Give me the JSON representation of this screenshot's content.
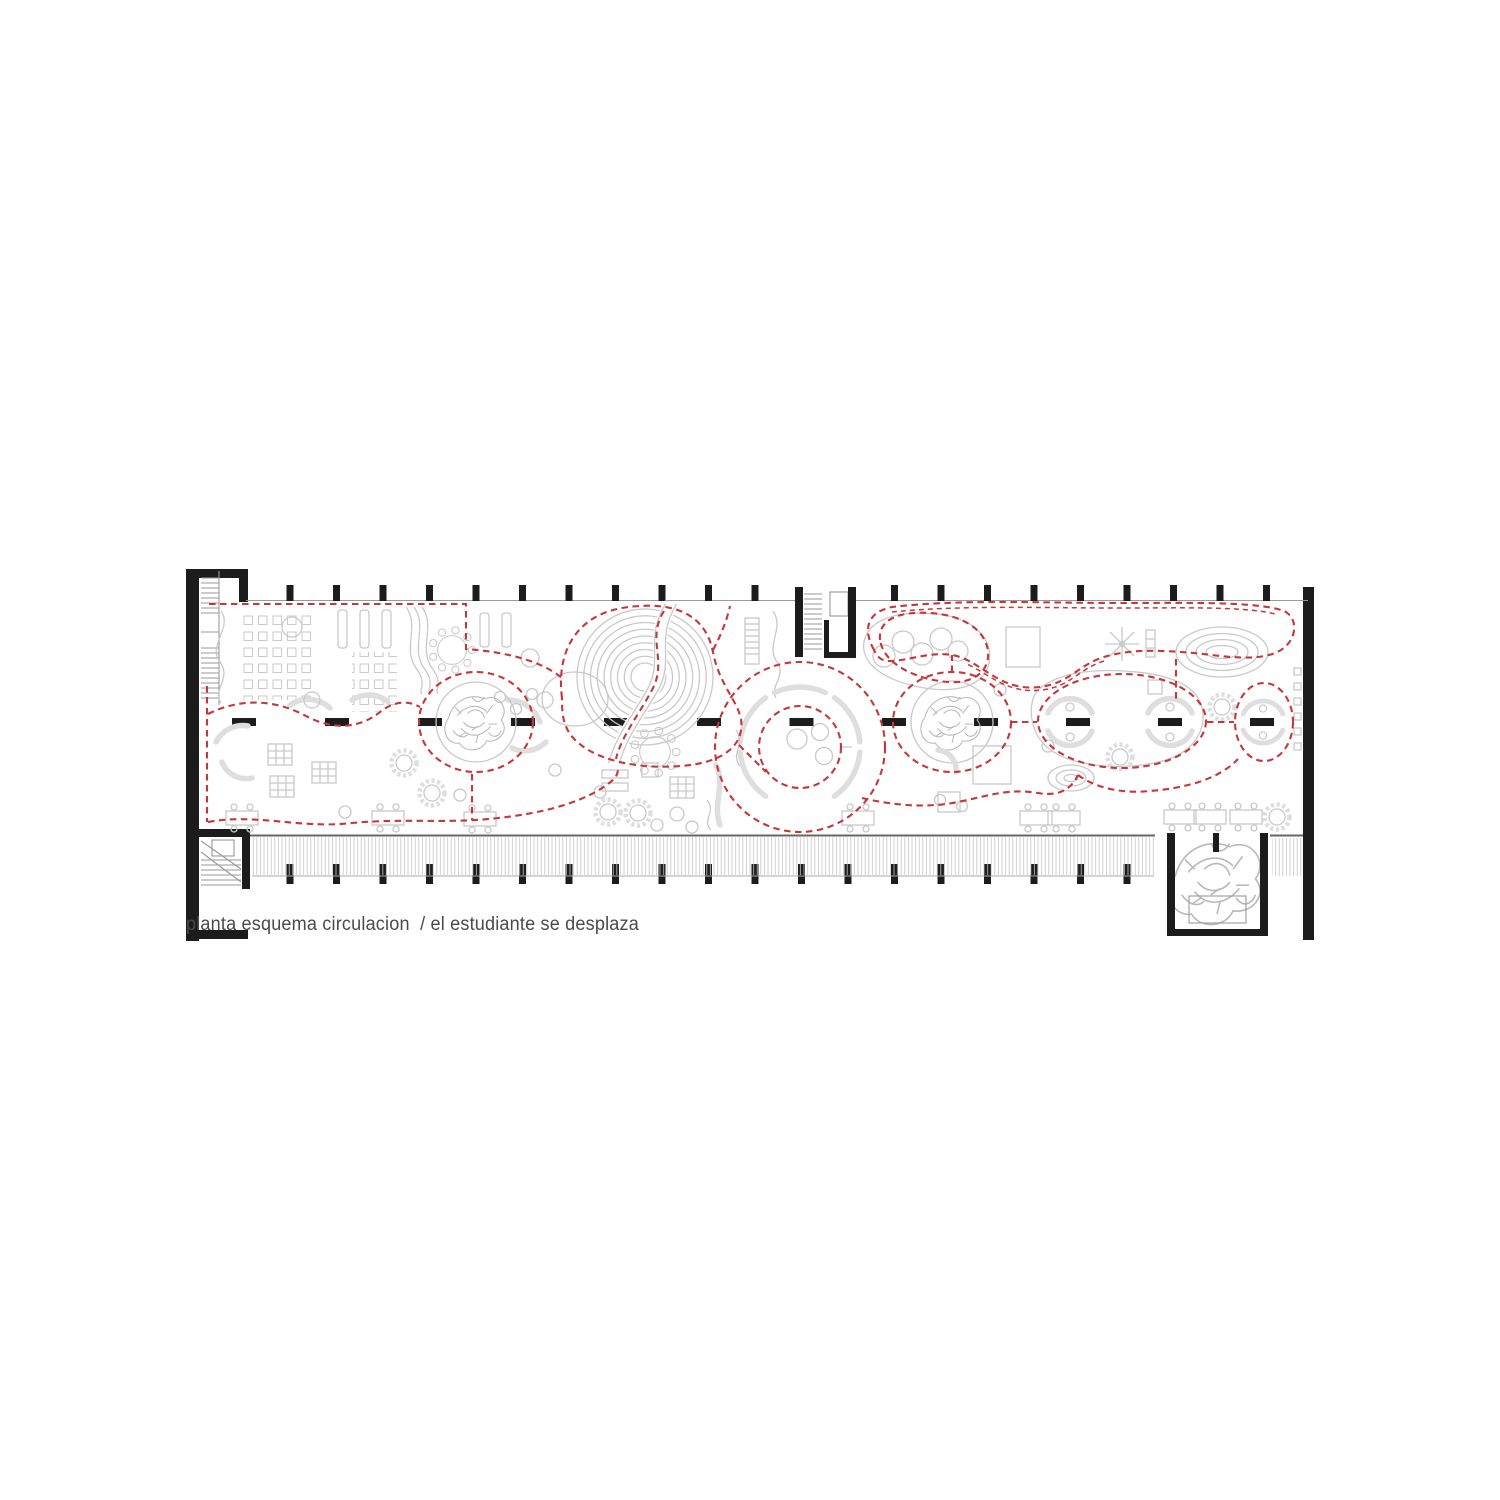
{
  "caption": {
    "text": "planta esquema circulacion  / el estudiante se desplaza",
    "title": "planta esquema circulacion",
    "subtitle": "el estudiante se desplaza"
  },
  "colors": {
    "page-bg": "#ffffff",
    "wall": "#1c1c1c",
    "furniture": "#c9c9c9",
    "bench": "#dedede",
    "tree": "#b9b9b9",
    "hatch": "#c5c5c5",
    "outline": "#9a9a9a",
    "circulation": "#c4373a",
    "caption": "#4a4a4a"
  },
  "drawing": {
    "type": "architectural-floor-plan",
    "layers": [
      "perimeter walls and columns",
      "interior wall stubs on central axis",
      "furniture and seating (light gray)",
      "spiral amphitheater",
      "tree courtyards",
      "stair cores",
      "hatched terrace deck",
      "projecting courtyard with tree and planter",
      "red dashed circulation paths"
    ]
  }
}
